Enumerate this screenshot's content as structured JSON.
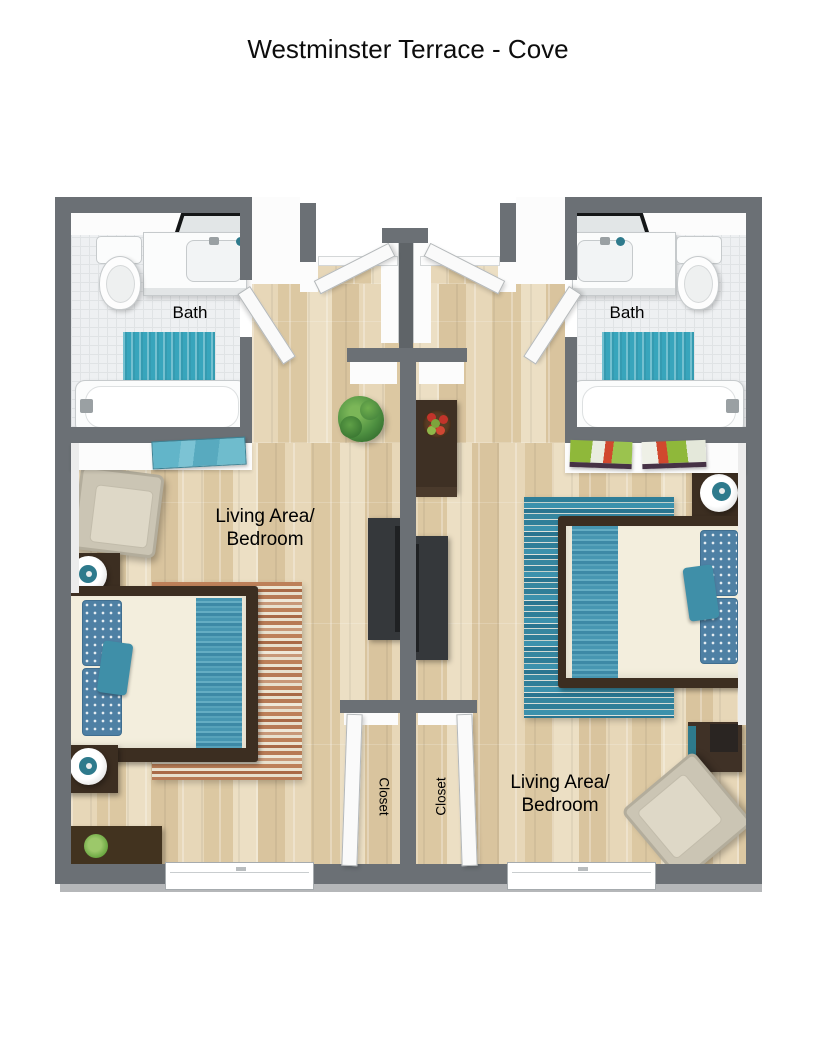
{
  "title": "Westminster Terrace - Cove",
  "labels": {
    "bath_left": "Bath",
    "bath_right": "Bath",
    "living_left_line1": "Living Area/",
    "living_left_line2": "Bedroom",
    "living_right_line1": "Living Area/",
    "living_right_line2": "Bedroom",
    "closet_left": "Closet",
    "closet_right": "Closet"
  },
  "colors": {
    "wall": "#6b7075",
    "wall_light": "#b5b7b9",
    "wood_floor": "#e0cfae",
    "tile_floor": "#eef0f2",
    "teal_accent": "#38a5bc",
    "teal_dark": "#2e7a8c",
    "pillow_blue": "#4e80a4",
    "dark_wood": "#3c2e21",
    "charcoal": "#35383b",
    "chair_beige": "#cbc5b4",
    "duvet": "#f3eedd",
    "rug_left_stripe": "#a96a47",
    "rug_right_stripe": "#2f7e98",
    "plant_green": "#3e7d3a",
    "title_text": "#0d0d0d"
  }
}
